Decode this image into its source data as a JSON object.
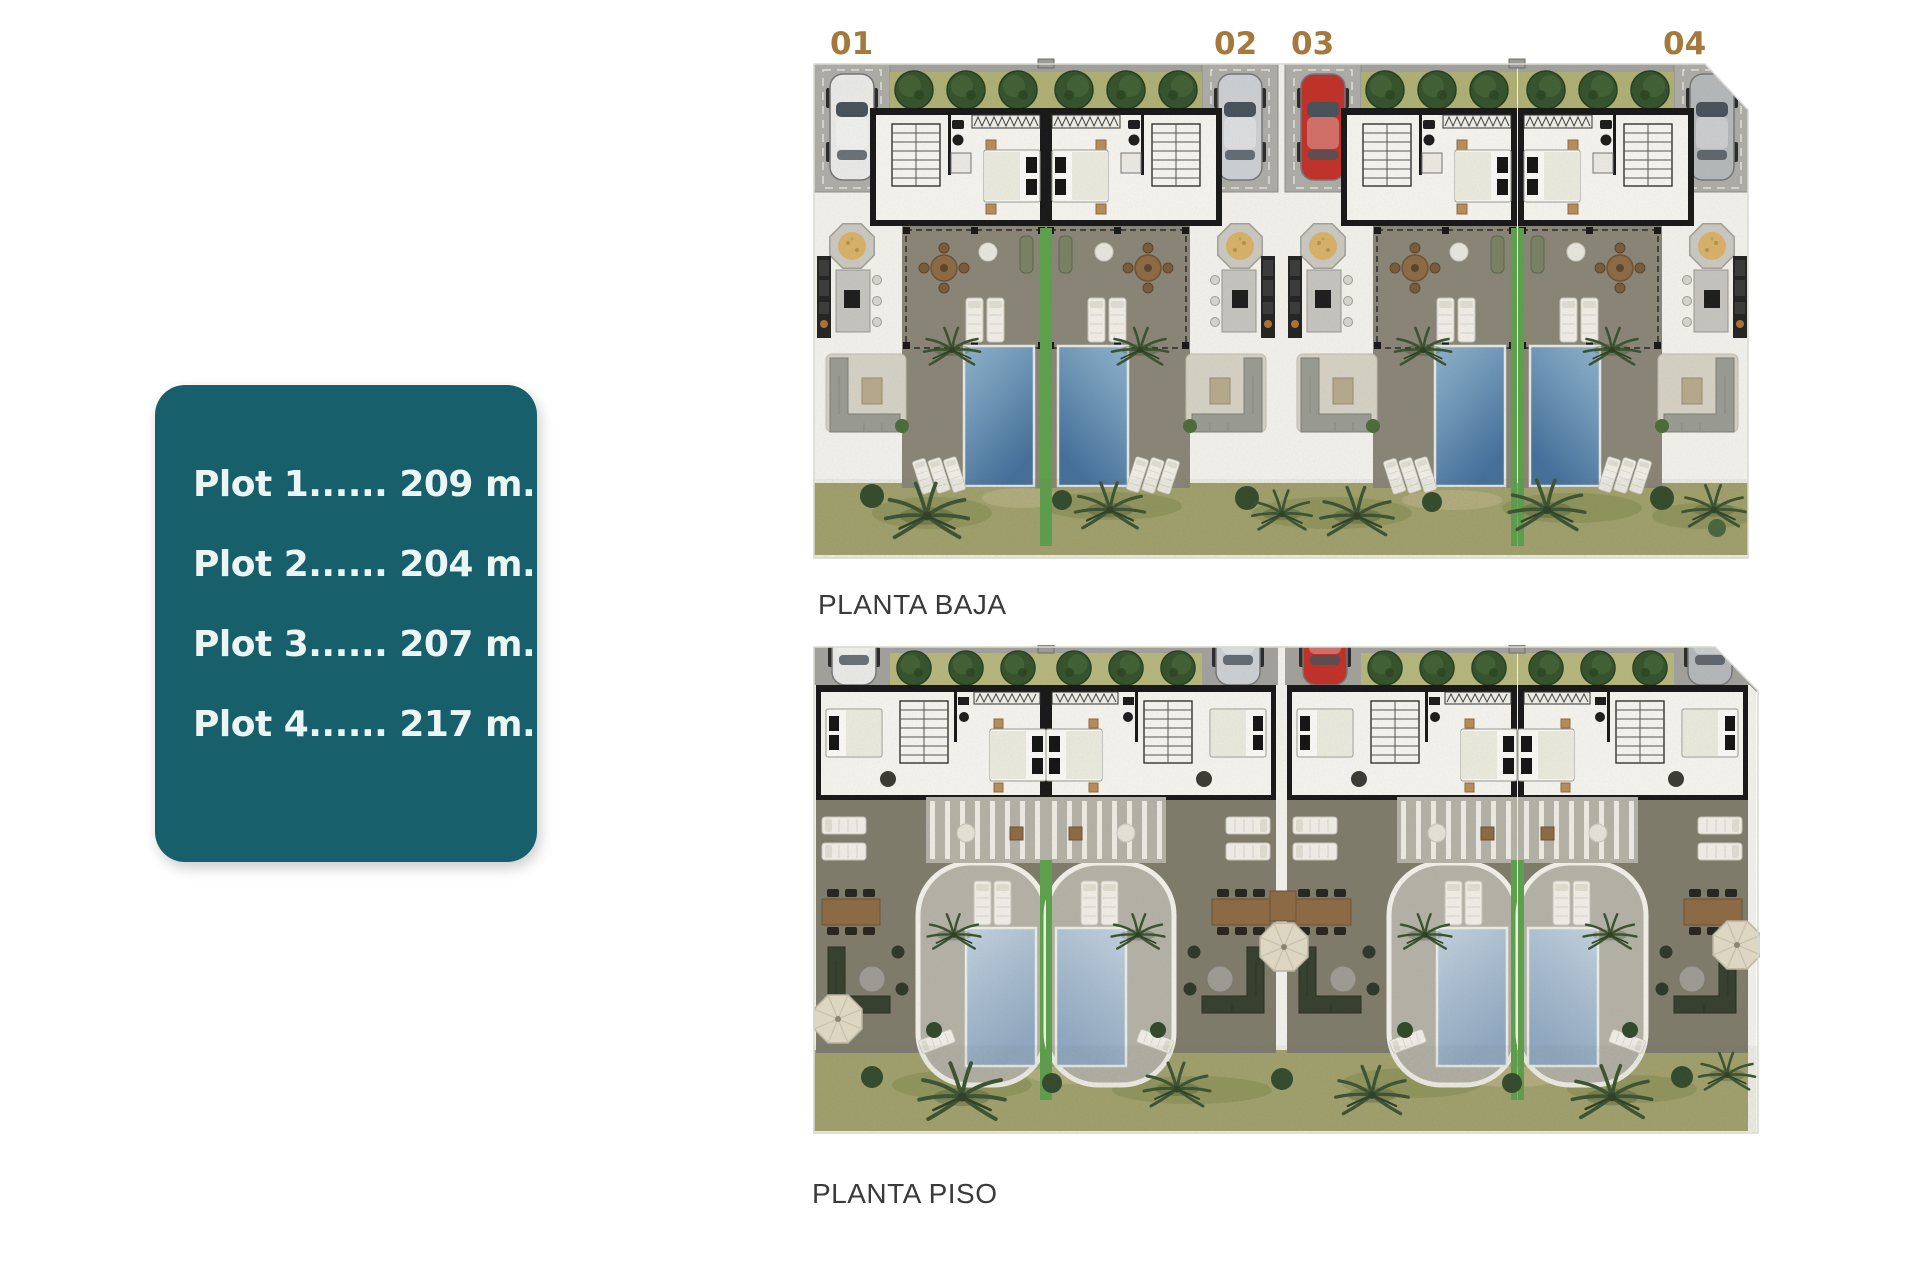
{
  "info_card": {
    "lines": [
      "Plot 1...... 209 m.",
      "Plot 2...... 204 m.",
      "Plot 3...... 207 m.",
      "Plot 4...... 217 m."
    ]
  },
  "plans": {
    "baja": {
      "title": "PLANTA BAJA",
      "unit_labels": [
        "01",
        "02",
        "03",
        "04"
      ]
    },
    "piso": {
      "title": "PLANTA PISO"
    }
  },
  "colors": {
    "teal_card_bg": "#17606b",
    "card_text": "#eaf5f4",
    "unit_label_gold": "#a5783c",
    "plan_title_text": "#3a3a3a",
    "page_bg": "#ffffff",
    "parking_gray": "#a3a29d",
    "garage_slab": "#aeada7",
    "hedge_green": "#35532c",
    "hedge_grass": "#b0b176",
    "wall_black": "#181818",
    "interior_white": "#f3f2ec",
    "terrace_dark_baja": "#8a8577",
    "terrace_dark_piso": "#7f7c6c",
    "deck_light": "#b5b2a7",
    "pool_deep_top": "#8fb3cd",
    "pool_deep_bottom": "#44709c",
    "pool_pale_top": "#c3d2df",
    "pool_pale_bottom": "#90a9c2",
    "lawn_green": "#5da24c",
    "garden_olive": "#a4a46e",
    "palm_green": "#3a5230",
    "furniture_white": "#f1efe8",
    "wood_brown": "#8d6a44",
    "sofa_gray": "#9a9c94",
    "sofa_dark_green": "#37402f",
    "stone_tan": "#d8b269",
    "parasol_beige": "#ddd6c3"
  }
}
